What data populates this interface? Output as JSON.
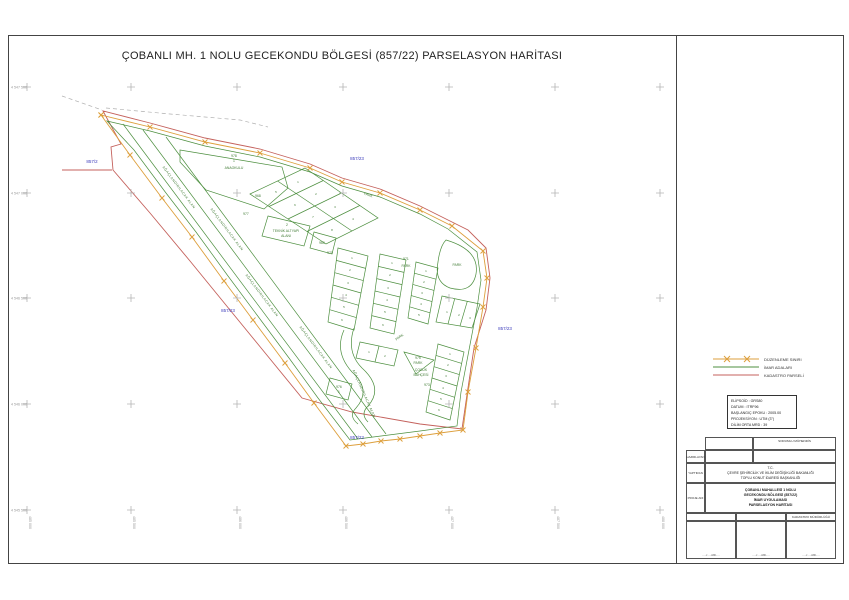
{
  "page": {
    "title": "ÇOBANLI MH. 1 NOLU GECEKONDU BÖLGESİ (857/22) PARSELASYON HARİTASI"
  },
  "colors": {
    "imar_green": "#4d8f3f",
    "kadastro_red": "#c4615c",
    "duzenleme_orange": "#dd9f3c",
    "parcel_blue": "#3b3bbb",
    "grid_gray": "#b5b5b5"
  },
  "legend": {
    "items": [
      {
        "label": "DÜZENLEME SINIRI",
        "color": "#dd9f3c",
        "style": "x-line"
      },
      {
        "label": "İMAR ADALARI",
        "color": "#4d8f3f",
        "style": "line"
      },
      {
        "label": "KADASTRO PARSELİ",
        "color": "#c4615c",
        "style": "line"
      }
    ]
  },
  "projection_box": {
    "lines": [
      "ELİPSOİD : GRS80",
      "DATUM : ITRF96",
      "BAŞLANGIÇ EPOKU : 2005.00",
      "PROJEKSİYON : UTM (3°)",
      "DİLİM ORTA MRD : 39"
    ]
  },
  "title_block": {
    "sorumlu_header": "SORUMLU MÜHENDİS",
    "hazirlayan_label": "HAZIRLAYAN",
    "yaptiran_label": "YAPTIRAN",
    "proje_adi_label": "PROJE ADI",
    "yaptiran_lines": [
      "T.C.",
      "ÇEVRE ŞEHİRCİLİK VE İKLİM DEĞİŞİKLİĞİ BAKANLIĞI",
      "TOPLU KONUT İDARESİ BAŞKANLIĞI"
    ],
    "proje_lines": [
      "ÇOBANLI MAHALLESİ 1 NOLU",
      "GECEKONDU BÖLGESİ (857/22)",
      "İMAR UYGULAMASI",
      "PARSELASYON HARİTASI"
    ],
    "kadastro_header": "KADASTRO MÜDÜRLÜĞÜ",
    "date_placeholder": "...../...../20....."
  },
  "map": {
    "left_coords": [
      "4 547 500",
      "4 547 000",
      "4 546 500",
      "4 546 000",
      "4 545 500"
    ],
    "bottom_coords": [
      "485 000",
      "485 500",
      "486 000",
      "486 500",
      "487 000",
      "487 500",
      "488 000"
    ],
    "cadastral_labels": [
      {
        "t": "857/2",
        "x": 92,
        "y": 163
      },
      {
        "t": "857/23",
        "x": 357,
        "y": 160
      },
      {
        "t": "857/23",
        "x": 228,
        "y": 312
      },
      {
        "t": "857/23",
        "x": 505,
        "y": 330
      },
      {
        "t": "857/23",
        "x": 357,
        "y": 439
      }
    ],
    "area_labels": [
      {
        "t": "978",
        "x": 234,
        "y": 157
      },
      {
        "t": "1",
        "x": 234,
        "y": 162
      },
      {
        "t": "ANAOKULU",
        "x": 234,
        "y": 169
      },
      {
        "t": "968",
        "x": 258,
        "y": 197
      },
      {
        "t": "977",
        "x": 246,
        "y": 215
      },
      {
        "t": "2",
        "x": 287,
        "y": 226
      },
      {
        "t": "TEKNİK ALTYAPI",
        "x": 286,
        "y": 232
      },
      {
        "t": "ALANI",
        "x": 286,
        "y": 237
      },
      {
        "t": "980",
        "x": 322,
        "y": 244
      },
      {
        "t": "PARK",
        "x": 368,
        "y": 196,
        "r": 20
      },
      {
        "t": "970",
        "x": 330,
        "y": 254
      },
      {
        "t": "971",
        "x": 406,
        "y": 260
      },
      {
        "t": "PARK",
        "x": 406,
        "y": 267
      },
      {
        "t": "PARK",
        "x": 457,
        "y": 266
      },
      {
        "t": "PARK",
        "x": 400,
        "y": 338,
        "r": -35
      },
      {
        "t": "975",
        "x": 418,
        "y": 359
      },
      {
        "t": "PARK",
        "x": 418,
        "y": 364
      },
      {
        "t": "976",
        "x": 339,
        "y": 388
      },
      {
        "t": "1",
        "x": 339,
        "y": 393
      },
      {
        "t": "ÇOCUK",
        "x": 421,
        "y": 371
      },
      {
        "t": "BAHÇESİ",
        "x": 421,
        "y": 376
      },
      {
        "t": "973",
        "x": 427,
        "y": 386
      }
    ],
    "road_labels": [
      {
        "t": "AĞAÇLANDIRILACAK ALAN",
        "x": 178,
        "y": 188,
        "r": 53
      },
      {
        "t": "AĞAÇLANDIRILACAK ALAN",
        "x": 261,
        "y": 296,
        "r": 53
      },
      {
        "t": "AĞAÇLANDIRILACAK ALAN",
        "x": 226,
        "y": 230,
        "r": 53
      },
      {
        "t": "AĞAÇLANDIRILACAK ALAN",
        "x": 315,
        "y": 348,
        "r": 53
      },
      {
        "t": "AĞAÇLANDIRILACAK ALAN",
        "x": 363,
        "y": 394,
        "r": 66
      }
    ],
    "parcel_numbers": [
      {
        "t": "1",
        "x": 298,
        "y": 183
      },
      {
        "t": "2",
        "x": 316,
        "y": 195
      },
      {
        "t": "3",
        "x": 335,
        "y": 208
      },
      {
        "t": "4",
        "x": 353,
        "y": 220
      },
      {
        "t": "5",
        "x": 276,
        "y": 193
      },
      {
        "t": "6",
        "x": 295,
        "y": 206
      },
      {
        "t": "7",
        "x": 313,
        "y": 218
      },
      {
        "t": "8",
        "x": 332,
        "y": 231
      },
      {
        "t": "1",
        "x": 352,
        "y": 259
      },
      {
        "t": "2",
        "x": 350,
        "y": 271
      },
      {
        "t": "3",
        "x": 348,
        "y": 284
      },
      {
        "t": "4",
        "x": 346,
        "y": 296
      },
      {
        "t": "5",
        "x": 344,
        "y": 308
      },
      {
        "t": "6",
        "x": 342,
        "y": 321
      },
      {
        "t": "1",
        "x": 392,
        "y": 264
      },
      {
        "t": "2",
        "x": 390,
        "y": 276
      },
      {
        "t": "3",
        "x": 388,
        "y": 289
      },
      {
        "t": "4",
        "x": 387,
        "y": 301
      },
      {
        "t": "5",
        "x": 385,
        "y": 313
      },
      {
        "t": "6",
        "x": 383,
        "y": 326
      },
      {
        "t": "1",
        "x": 426,
        "y": 272
      },
      {
        "t": "2",
        "x": 424,
        "y": 283
      },
      {
        "t": "3",
        "x": 422,
        "y": 294
      },
      {
        "t": "4",
        "x": 421,
        "y": 305
      },
      {
        "t": "5",
        "x": 419,
        "y": 316
      },
      {
        "t": "1",
        "x": 447,
        "y": 313
      },
      {
        "t": "2",
        "x": 459,
        "y": 316
      },
      {
        "t": "3",
        "x": 470,
        "y": 319
      },
      {
        "t": "1",
        "x": 450,
        "y": 355
      },
      {
        "t": "2",
        "x": 448,
        "y": 366
      },
      {
        "t": "3",
        "x": 446,
        "y": 377
      },
      {
        "t": "4",
        "x": 443,
        "y": 389
      },
      {
        "t": "5",
        "x": 441,
        "y": 400
      },
      {
        "t": "6",
        "x": 439,
        "y": 411
      },
      {
        "t": "1",
        "x": 369,
        "y": 353
      },
      {
        "t": "2",
        "x": 385,
        "y": 357
      }
    ]
  }
}
